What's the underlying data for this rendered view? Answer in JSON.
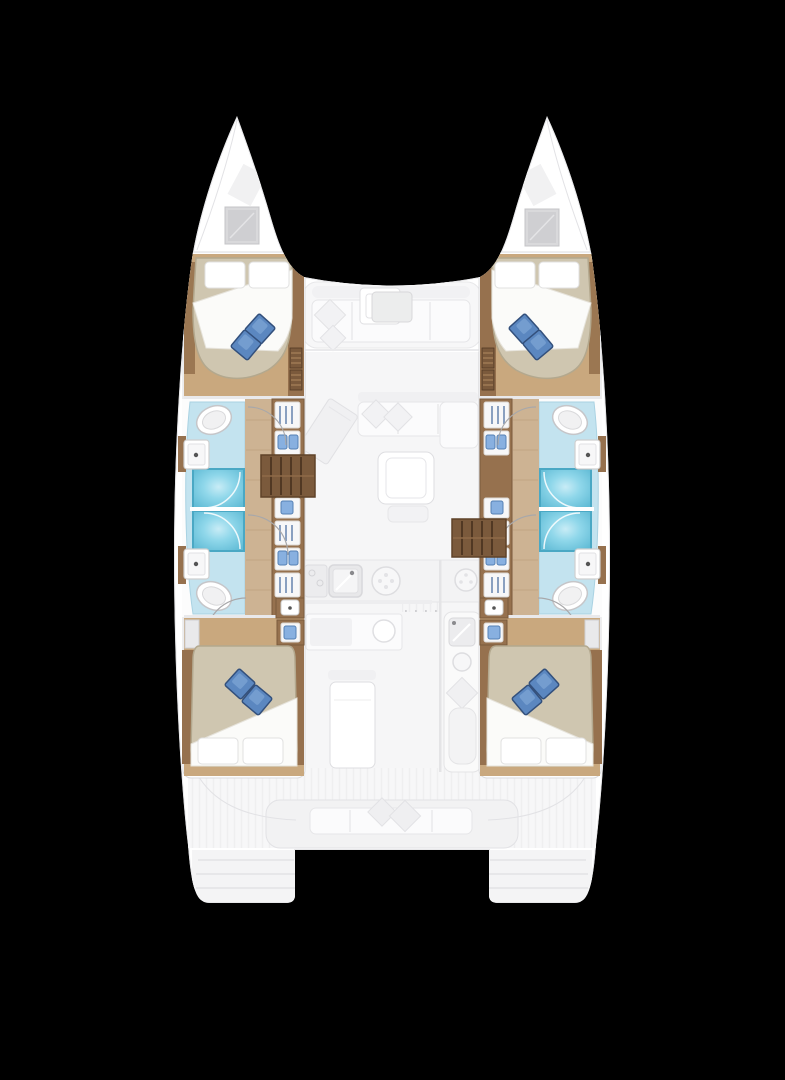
{
  "figure": {
    "kind": "yacht-floorplan",
    "subject": "catamaran four-cabin interior layout, top-down view",
    "background": "#000000"
  },
  "palette": {
    "bg": "#000000",
    "hull": "#ffffff",
    "hull-stroke": "#e7e7e9",
    "ghost": "#f6f6f7",
    "ghost2": "#efeff1",
    "ghost-stroke": "#e2e2e5",
    "floor-tan": "#c9a87e",
    "walkway": "#cdb393",
    "wood-mid": "#96714e",
    "wood-dark": "#7b5a3c",
    "wood-deep": "#5f4228",
    "bath-blue": "#c3e3ef",
    "bath-stroke": "#a9d2e2",
    "shower": "#7ed0e6",
    "shower-stroke": "#4aa8c4",
    "mattress": "#cfc6b0",
    "mattress-stroke": "#b3a88e",
    "pillow-blue": "#5b87c0",
    "pillow-blue-dark": "#33507c",
    "pillow-blue-hi": "#85abd8",
    "item-blue": "#88b0e0"
  },
  "areas": {
    "boat": {
      "label": "catamaran hull silhouette"
    },
    "port_hull": {
      "label": "port hull: forward cabin, two bathrooms with showers, wardrobe, companionway steps, aft cabin"
    },
    "starboard_hull": {
      "label": "starboard hull: forward cabin, two bathrooms with showers, wardrobe, companionway steps, aft cabin"
    },
    "forward_cockpit": {
      "label": "forward cockpit lounge with seats, cushions and table"
    },
    "saloon": {
      "label": "saloon with chart table, L-shaped sofa and coffee table"
    },
    "galley": {
      "label": "galley with sink, stove burners and counters"
    },
    "aft_cockpit": {
      "label": "aft cockpit with table, bar unit and bench seat"
    },
    "transoms": {
      "label": "twin transom swim platforms with steps"
    },
    "fwd_cabin": {
      "label": "double berth with white pillows, folded sheet and two blue cushions"
    },
    "aft_cabin": {
      "label": "double berth with white pillows, folded sheet and two blue cushions"
    },
    "bathroom": {
      "label": "bathroom: toilet, washbasin and cyan shower cubicle"
    },
    "steps": {
      "label": "wooden companionway steps down into hull"
    }
  }
}
